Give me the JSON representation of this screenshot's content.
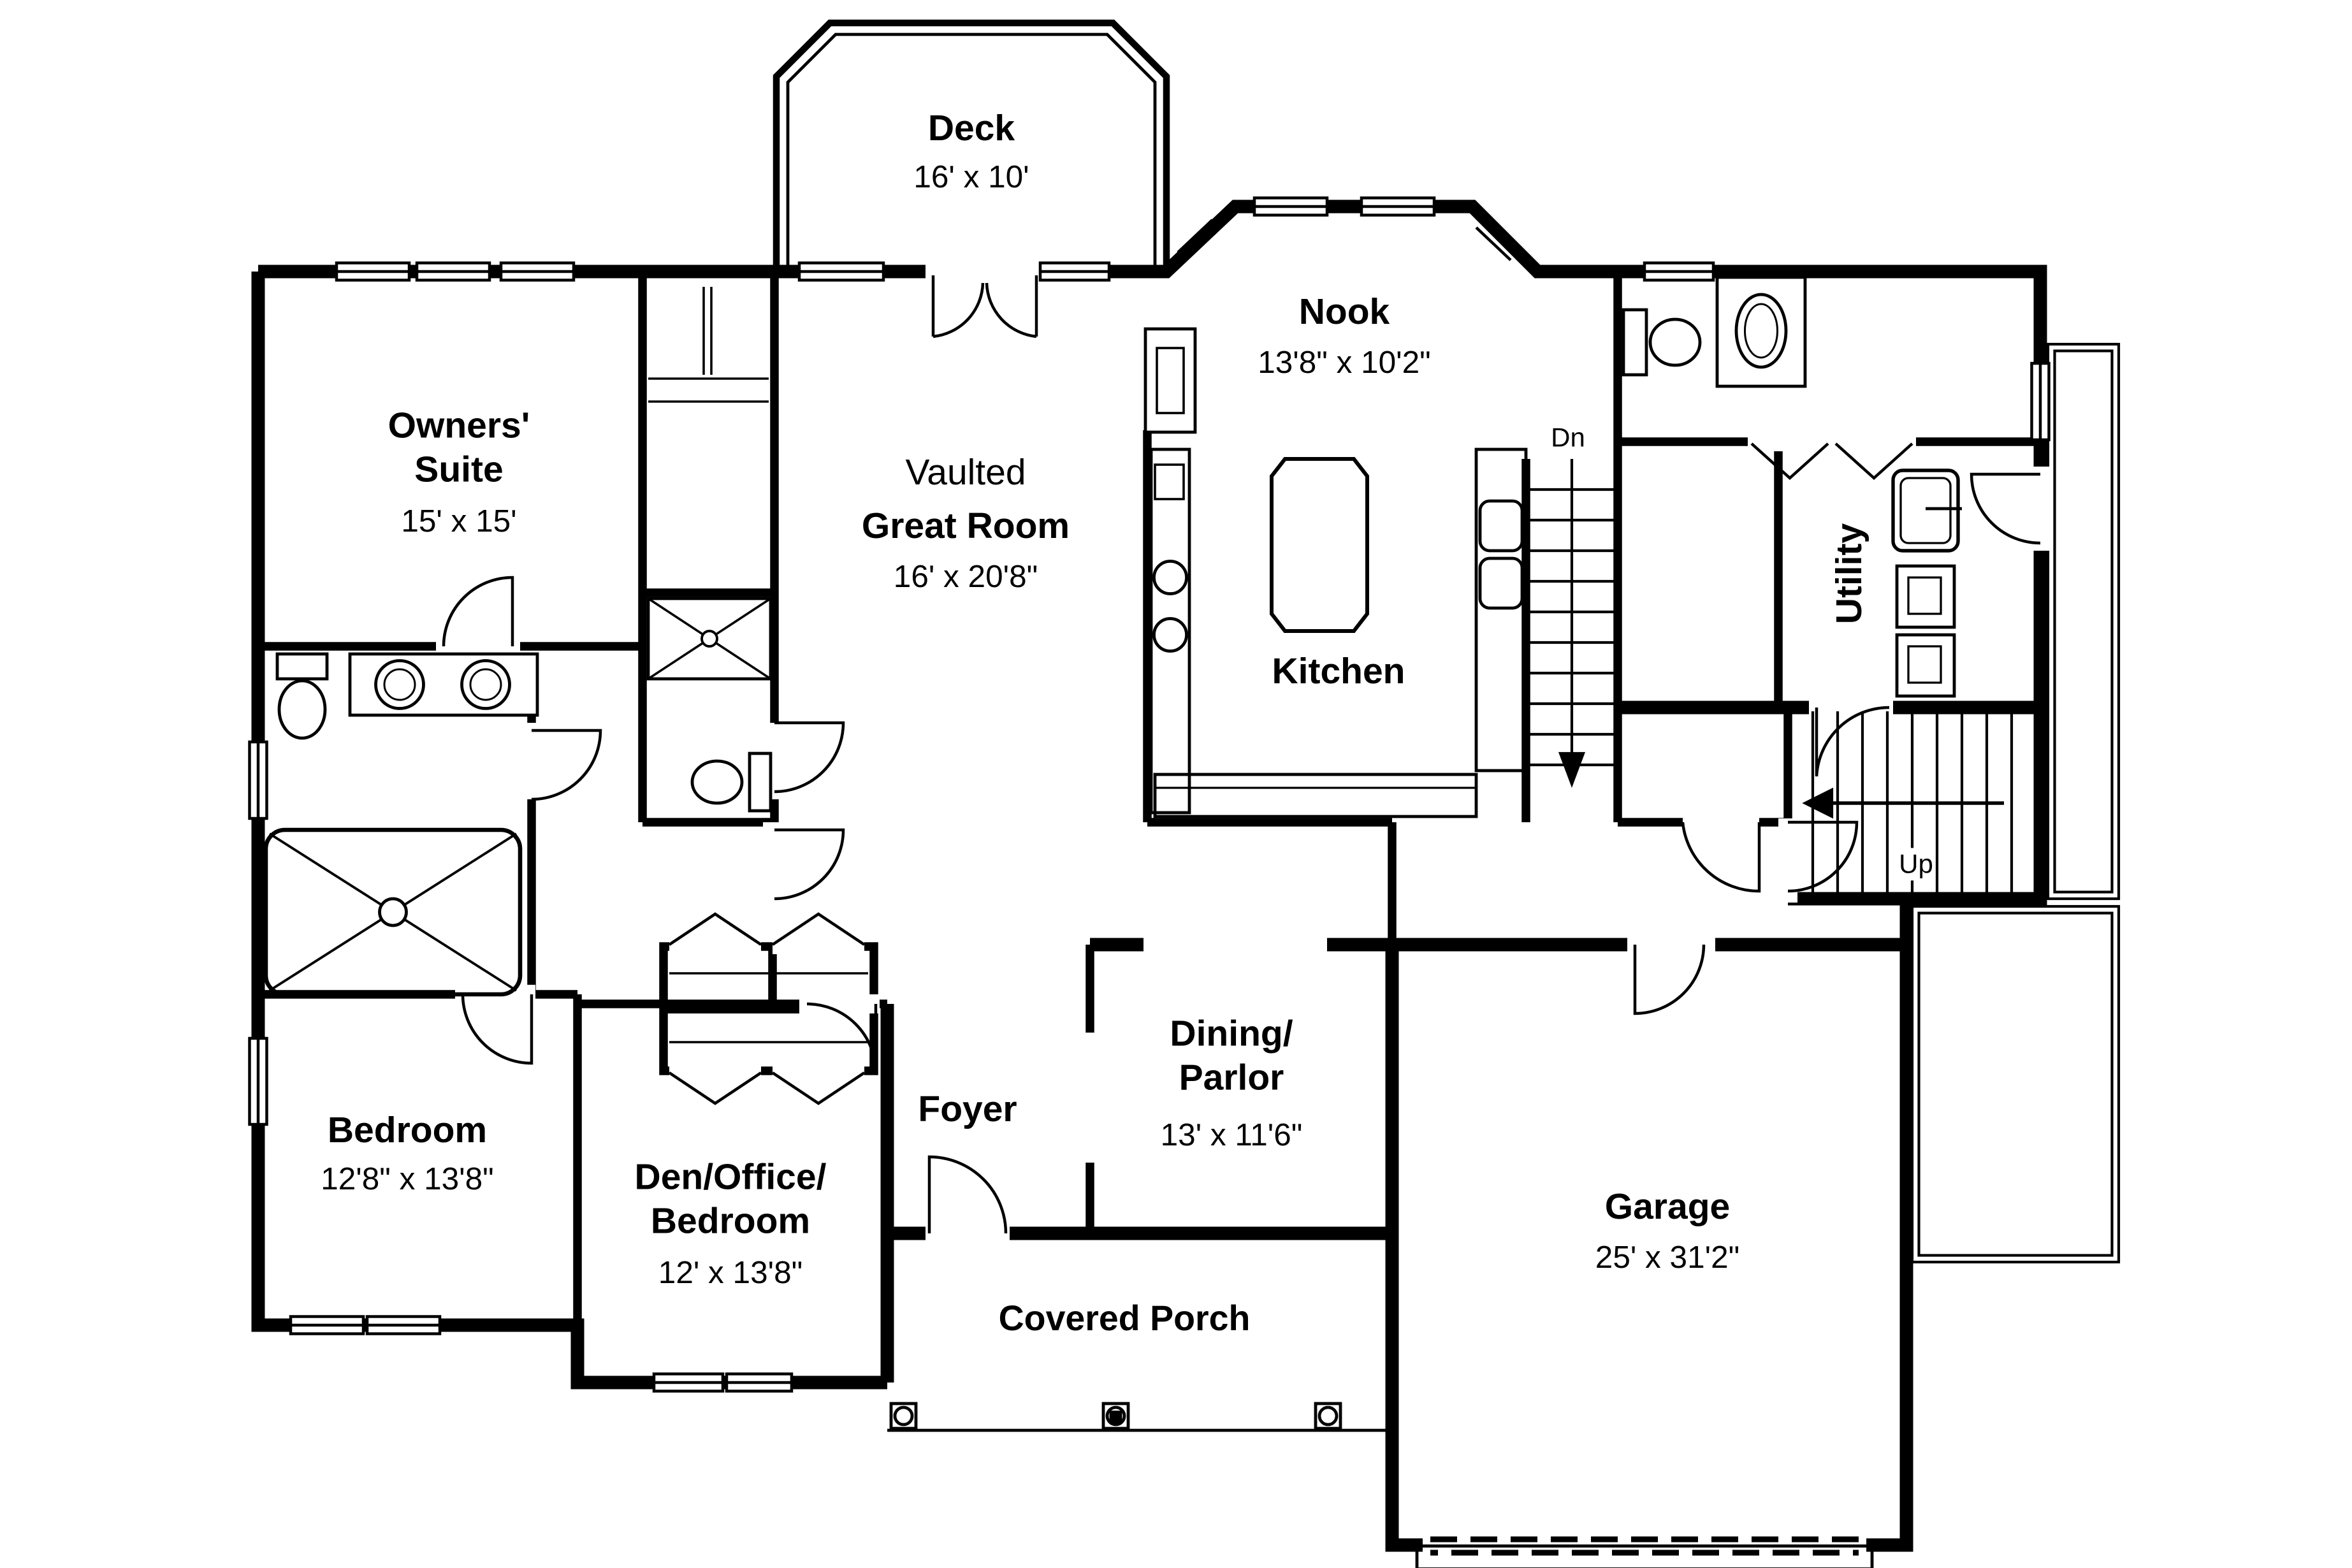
{
  "plan": {
    "title": "House floor plan - main level",
    "colors": {
      "ink": "#000000",
      "paper": "#ffffff"
    },
    "rooms": {
      "deck": {
        "name": "Deck",
        "dims": "16' x 10'"
      },
      "nook": {
        "name": "Nook",
        "dims": "13'8\" x 10'2\""
      },
      "owners_suite": {
        "name": "Owners' Suite",
        "dims": "15' x 15'"
      },
      "great_room": {
        "prefix": "Vaulted",
        "name": "Great Room",
        "dims": "16' x 20'8\""
      },
      "kitchen": {
        "name": "Kitchen"
      },
      "utility": {
        "name": "Utility"
      },
      "bedroom": {
        "name": "Bedroom",
        "dims": "12'8\" x 13'8\""
      },
      "den": {
        "name": "Den/Office/\nBedroom",
        "dims": "12' x 13'8\""
      },
      "foyer": {
        "name": "Foyer"
      },
      "dining": {
        "name": "Dining/\nParlor",
        "dims": "13' x 11'6\""
      },
      "covered_porch": {
        "name": "Covered Porch"
      },
      "garage": {
        "name": "Garage",
        "dims": "25' x 31'2\""
      }
    },
    "stairs": {
      "down": "Dn",
      "up": "Up"
    }
  }
}
